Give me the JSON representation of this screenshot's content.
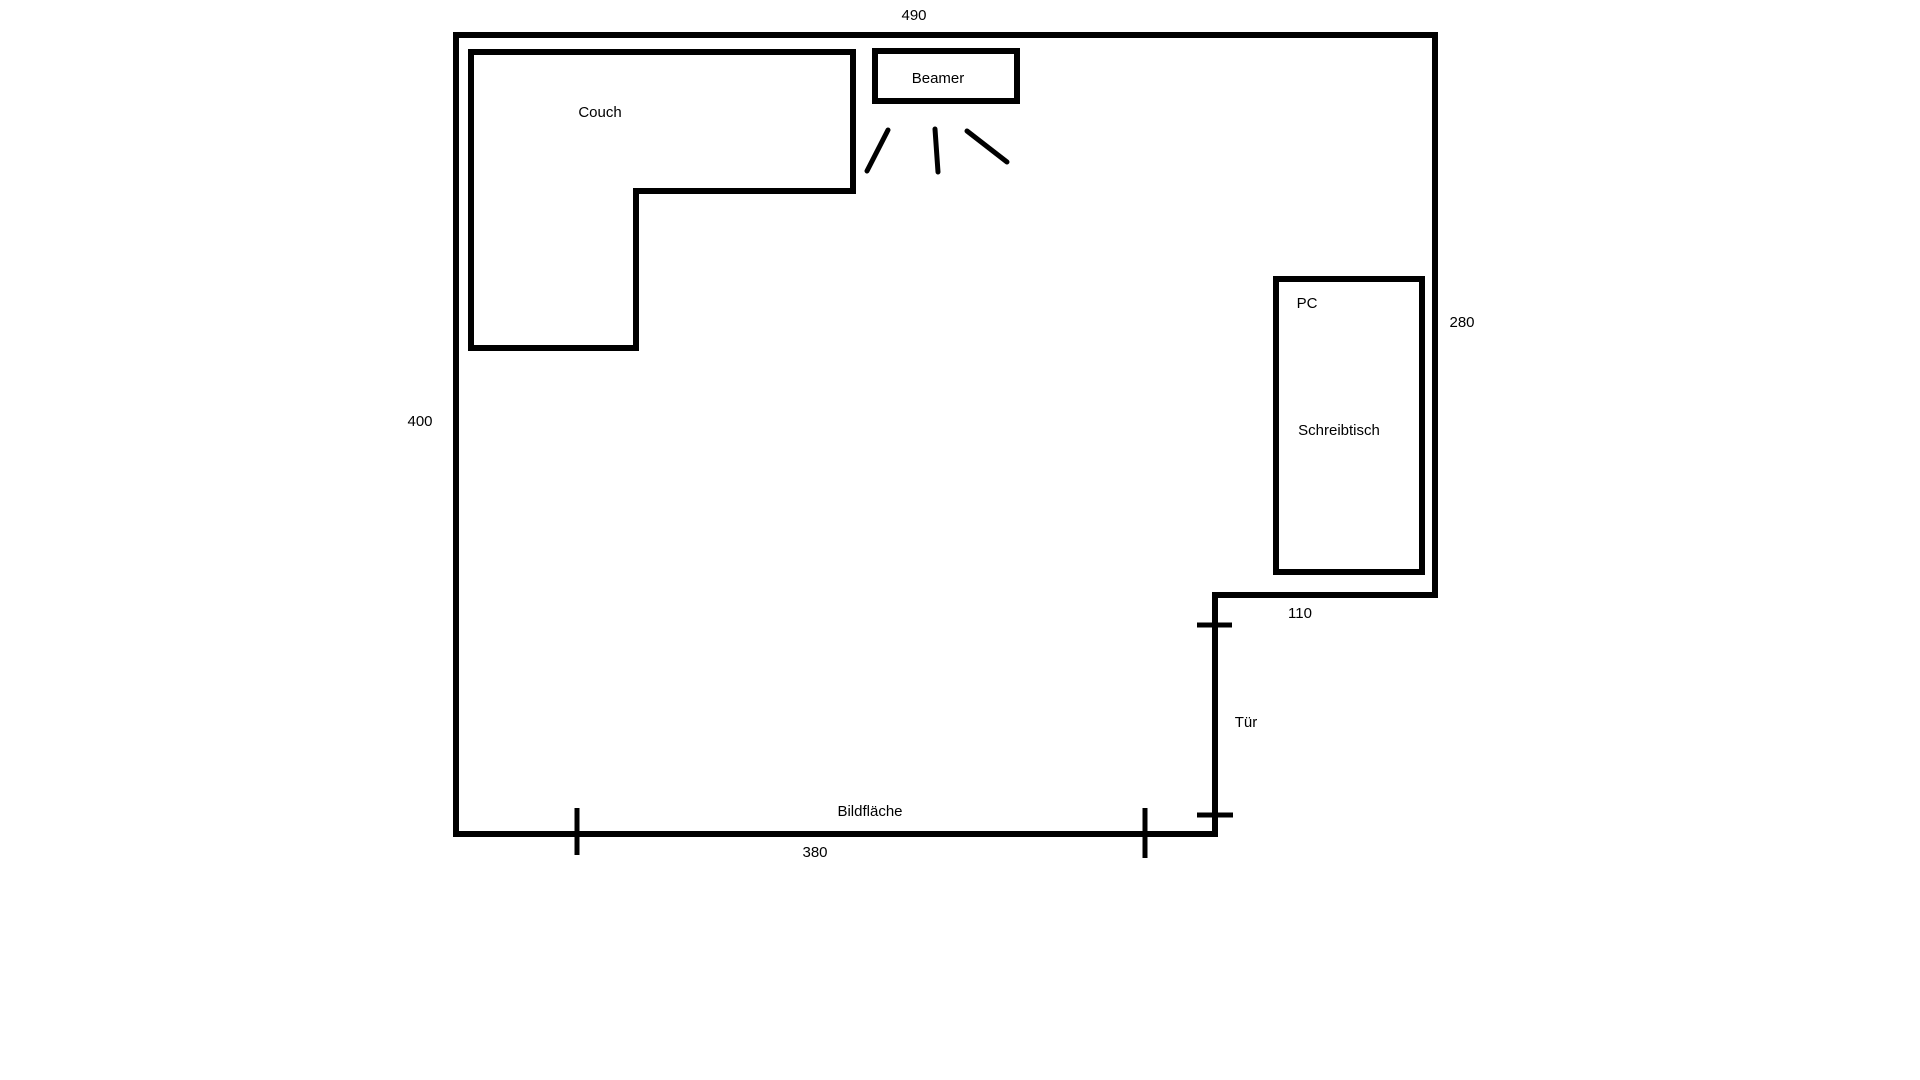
{
  "floor_plan": {
    "objects": {
      "couch": "Couch",
      "beamer": "Beamer",
      "pc": "PC",
      "desk": "Schreibtisch",
      "door": "Tür",
      "screen": "Bildfläche"
    },
    "dimensions": {
      "top_wall": "490",
      "left_wall": "400",
      "right_wall": "280",
      "niche": "110",
      "screen_wall": "380"
    },
    "colors": {
      "line": "#000000",
      "background": "#ffffff",
      "text": "#000000"
    }
  }
}
